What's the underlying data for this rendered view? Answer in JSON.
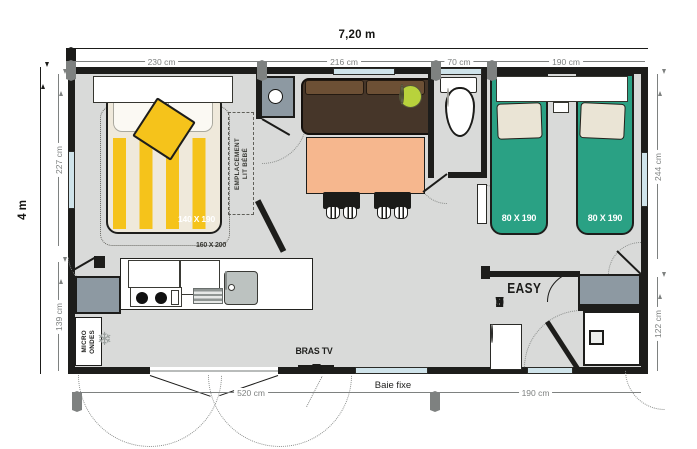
{
  "dimensions": {
    "top_total": "7,20 m",
    "top_segments": [
      "230 cm",
      "216 cm",
      "70 cm",
      "190 cm"
    ],
    "left_total": "4 m",
    "left_segments": [
      "227 cm",
      "139 cm"
    ],
    "right_segments": [
      "244 cm",
      "122 cm"
    ],
    "bottom_segments": [
      "520 cm",
      "190 cm"
    ]
  },
  "rooms": {
    "master_bedroom": {
      "bed_label": "140 X 190",
      "bed_zone_label": "160 X 200",
      "baby_zone_line1": "EMPLACEMENT",
      "baby_zone_line2": "LIT BÉBÉ"
    },
    "twin_bedroom": {
      "bed_left_label": "80 X 190",
      "bed_right_label": "80 X 190"
    },
    "kitchen": {
      "microwave_line1": "MICRO",
      "microwave_line2": "ONDES"
    },
    "bathroom": {
      "logo_line1": "EASY",
      "logo_line2_letters": [
        "C",
        "L",
        "E",
        "A",
        "N"
      ]
    }
  },
  "annotations": {
    "tv_label": "BRAS TV",
    "fixed_window_label": "Baie fixe"
  },
  "icons": {
    "snowflake_icon": "❄"
  },
  "colors": {
    "wall": "#1d1d1b",
    "floor": "#d9dad9",
    "dim_grey": "#7e8180",
    "stripe_yellow": "#f5c31b",
    "bed_cream": "#efe9db",
    "bed_green": "#2aa184",
    "pillow_cream": "#eae4d5",
    "sofa_brown": "#463629",
    "cushion_brown": "#6d5035",
    "table_orange": "#f6b78e",
    "lamp_lime": "#b8d23c",
    "unit_grey": "#8d99a2",
    "window_blue": "#cfe3ea"
  }
}
